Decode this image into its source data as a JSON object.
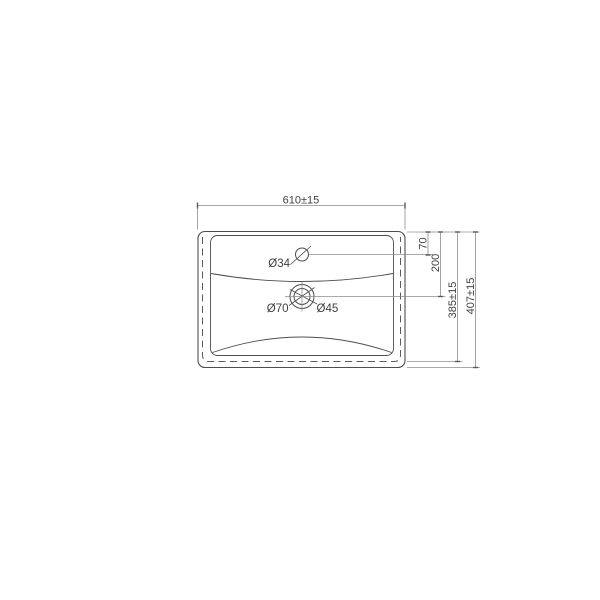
{
  "drawing": {
    "type": "technical-drawing",
    "subject": "Washbasin top view with installation dimensions",
    "colors": {
      "outline": "#4d4d4d",
      "dimension_line": "#8c8c8c",
      "hidden_line": "#5a5a5a",
      "text": "#3f3f3f",
      "background": "#ffffff"
    },
    "dims": {
      "width": "610±15",
      "overall_depth": "407±15",
      "hidden_edge_depth": "385±15",
      "faucet_center_offset": "70",
      "drain_center_offset": "200",
      "faucet_hole_diameter": "Ø34",
      "drain_outer_diameter": "Ø70",
      "drain_waste_diameter": "Ø45"
    }
  }
}
